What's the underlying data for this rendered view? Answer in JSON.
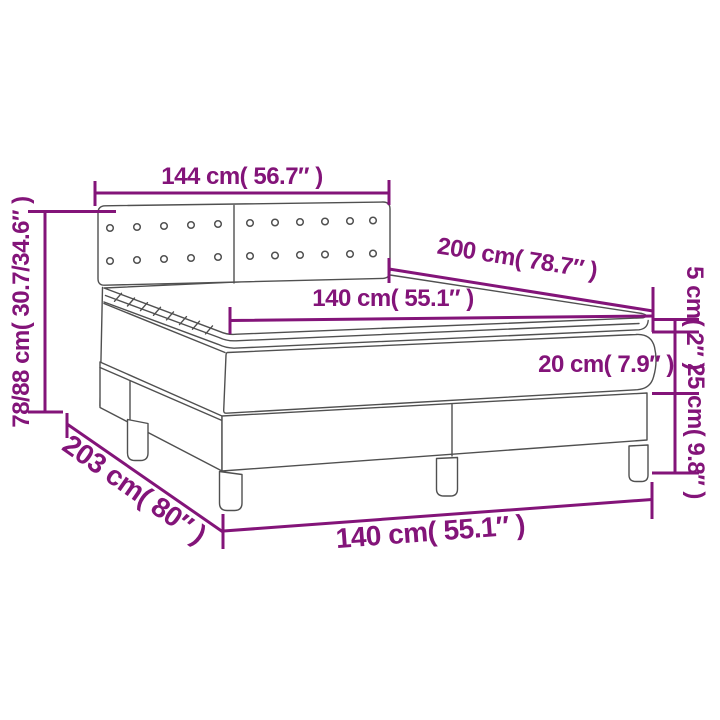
{
  "page": {
    "background": "#ffffff"
  },
  "palette": {
    "dimension_color": "#831479",
    "drawing_color": "#505050",
    "background": "#ffffff"
  },
  "diagram": {
    "kind": "product-dimension-diagram",
    "subject": "box spring bed with tufted headboard, mattress and topper",
    "labels": {
      "headboard_width": "144 cm( 56.7″ )",
      "overall_height": "78/88 cm( 30.7/34.6″ )",
      "bed_length": "200 cm( 78.7″ )",
      "mattress_width": "140 cm( 55.1″ )",
      "topper_height": "5 cm( 2″ )",
      "mattress_height": "20 cm( 7.9″ )",
      "base_height": "25 cm( 9.8″ )",
      "base_length": "203 cm( 80″ )",
      "base_width": "140 cm( 55.1″ )"
    }
  }
}
